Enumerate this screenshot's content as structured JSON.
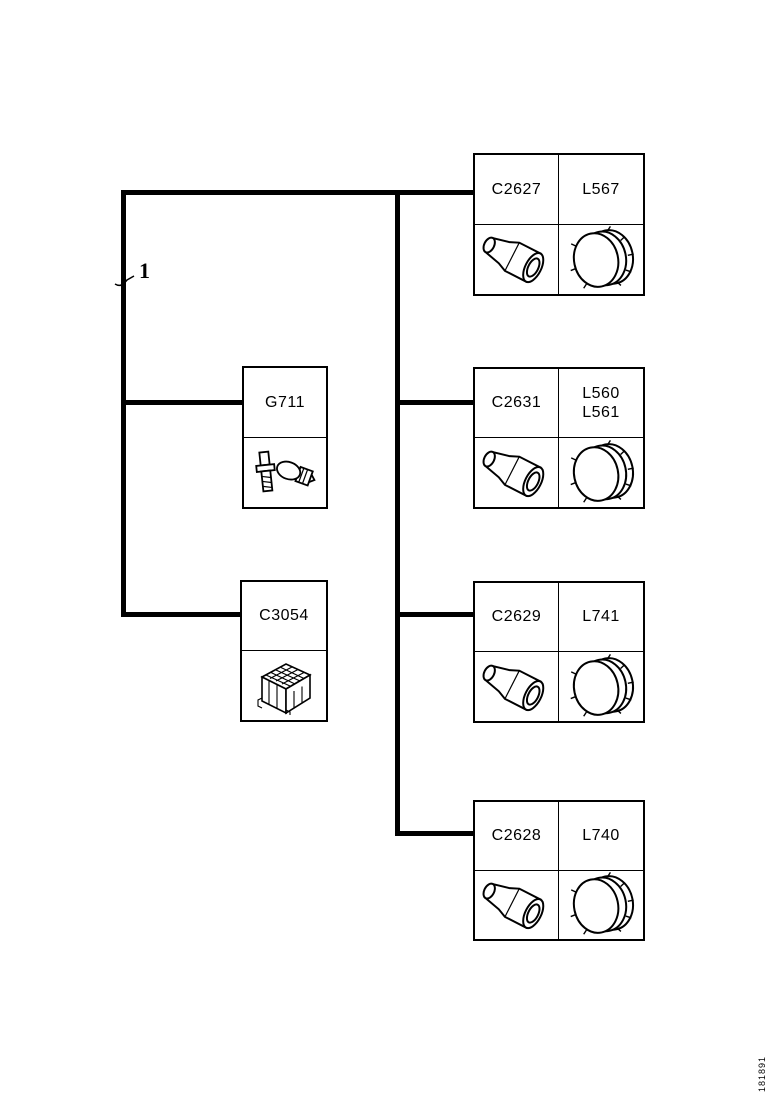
{
  "diagram": {
    "callout_label": "1",
    "doc_id": "181891",
    "colors": {
      "line": "#000000",
      "background": "#ffffff"
    },
    "left_parts": [
      {
        "code": "G711",
        "icon": "bulb-and-screw-icon"
      },
      {
        "code": "C3054",
        "icon": "connector-block-icon"
      }
    ],
    "right_parts": [
      {
        "connector": "C2627",
        "lamps": "L567",
        "socket_icon": "bulb-socket-icon",
        "lens_icon": "lamp-lens-icon"
      },
      {
        "connector": "C2631",
        "lamps": "L560\nL561",
        "socket_icon": "bulb-socket-icon",
        "lens_icon": "lamp-lens-icon"
      },
      {
        "connector": "C2629",
        "lamps": "L741",
        "socket_icon": "bulb-socket-icon",
        "lens_icon": "lamp-lens-icon"
      },
      {
        "connector": "C2628",
        "lamps": "L740",
        "socket_icon": "bulb-socket-icon",
        "lens_icon": "lamp-lens-icon"
      }
    ]
  }
}
